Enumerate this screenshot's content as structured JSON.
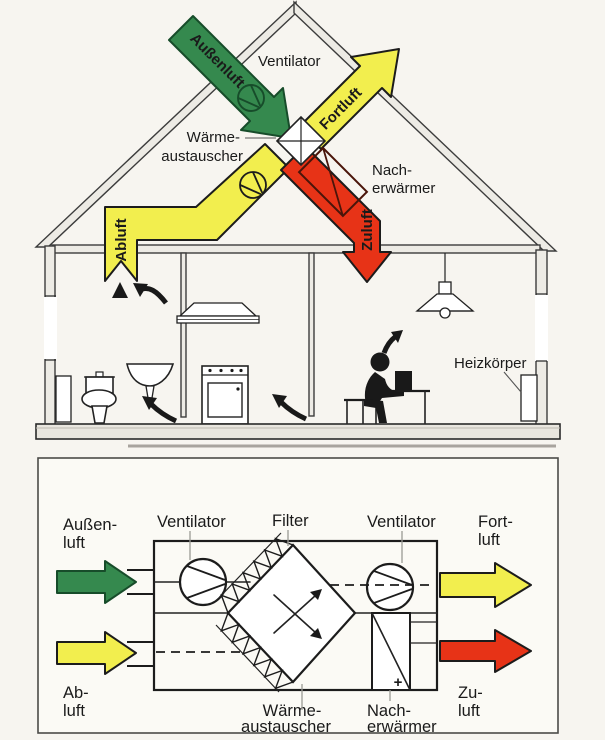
{
  "colors": {
    "green": "#35894e",
    "green_dark": "#14532d",
    "yellow": "#f2ee4e",
    "red": "#e73317",
    "zuluft_text": "#7c1507",
    "reheater_outline": "#4a150a",
    "line": "#1c1c1c",
    "panel_bg": "#fbfaf5",
    "background": "#f7f5f0"
  },
  "house": {
    "labels": {
      "aussenluft": "Außenluft",
      "ventilator": "Ventilator",
      "fortluft": "Fortluft",
      "waerme1": "Wärme-",
      "waerme2": "austauscher",
      "nach1": "Nach-",
      "nach2": "erwärmer",
      "abluft": "Abluft",
      "zuluft": "Zuluft",
      "heizkoerper": "Heizkörper"
    }
  },
  "unit": {
    "labels": {
      "aussen1": "Außen-",
      "aussen2": "luft",
      "ventilator_left": "Ventilator",
      "filter": "Filter",
      "ventilator_right": "Ventilator",
      "fort1": "Fort-",
      "fort2": "luft",
      "ab1": "Ab-",
      "ab2": "luft",
      "zu1": "Zu-",
      "zu2": "luft",
      "waerme1": "Wärme-",
      "waerme2": "austauscher",
      "nach1": "Nach-",
      "nach2": "erwärmer",
      "plus": "+"
    }
  }
}
